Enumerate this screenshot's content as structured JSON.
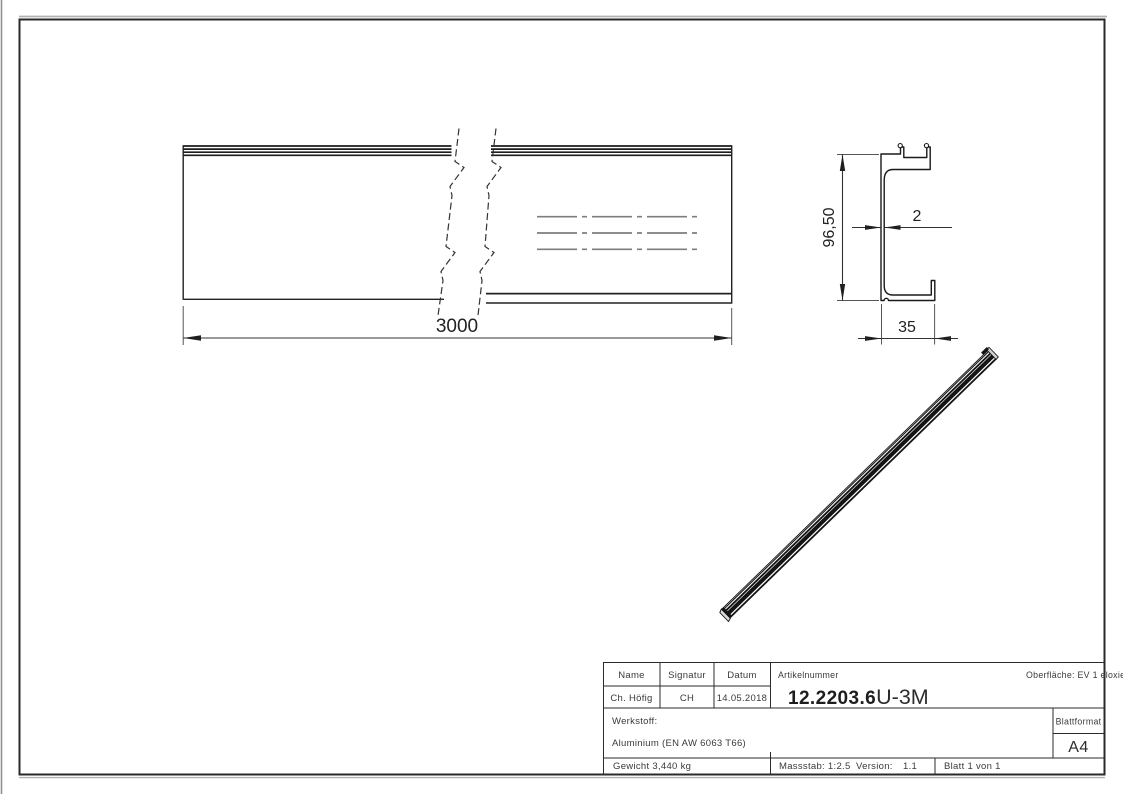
{
  "colors": {
    "line": "#1f1f1f",
    "dim_line": "#333333",
    "ext_line": "#555555",
    "centerline": "#7d7d7d",
    "page_shadow": "#a8a8a8",
    "iso_fill": "#141414"
  },
  "dimensions": {
    "length": "3000",
    "height": "96,50",
    "thickness": "2",
    "width": "35"
  },
  "title_block": {
    "headers": {
      "name": "Name",
      "signatur": "Signatur",
      "datum": "Datum"
    },
    "values": {
      "name": "Ch. Höfig",
      "signatur": "CH",
      "datum": "14.05.2018"
    },
    "artikelnummer_label": "Artikelnummer",
    "artikelnummer_bold": "12.2203.6",
    "artikelnummer_suffix": "U-3M",
    "oberflaeche": "Oberfläche: EV 1 eloxiert",
    "werkstoff_label": "Werkstoff:",
    "werkstoff_value": "Aluminium (EN AW 6063 T66)",
    "blattformat_label": "Blattformat",
    "blattformat_value": "A4",
    "gewicht": "Gewicht 3,440 kg",
    "massstab": "Massstab: 1:2.5",
    "version_label": "Version:",
    "version_value": "1.1",
    "blatt": "Blatt 1 von 1"
  }
}
